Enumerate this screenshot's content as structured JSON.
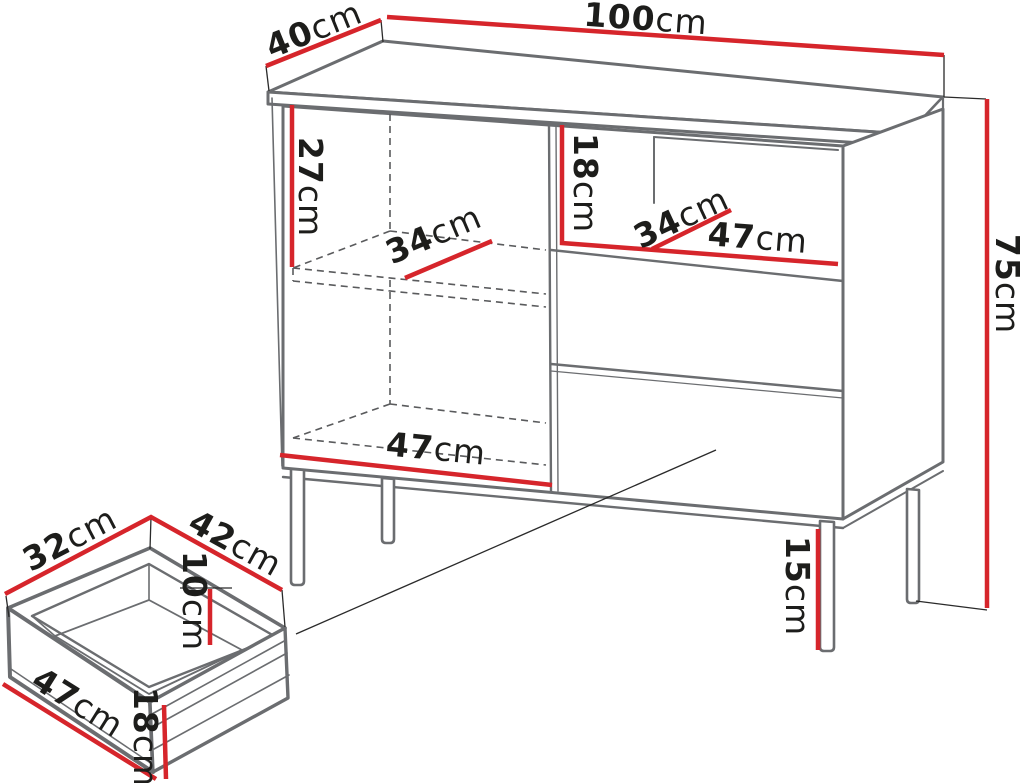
{
  "unit": "cm",
  "colors": {
    "dimension_line": "#d6252b",
    "outline": "#6b6d70",
    "label_text": "#1d1d1b",
    "background": "#ffffff"
  },
  "cabinet": {
    "width": "100",
    "depth": "40",
    "height": "75",
    "leg_height": "15",
    "left_compartment": {
      "interior_height": "27",
      "shelf_depth": "34",
      "interior_width": "47"
    },
    "niche": {
      "height": "18",
      "depth": "34",
      "width": "47"
    }
  },
  "drawer_detail": {
    "top_depth": "32",
    "top_width": "42",
    "interior_height": "10",
    "front_width": "47",
    "front_height": "18"
  }
}
